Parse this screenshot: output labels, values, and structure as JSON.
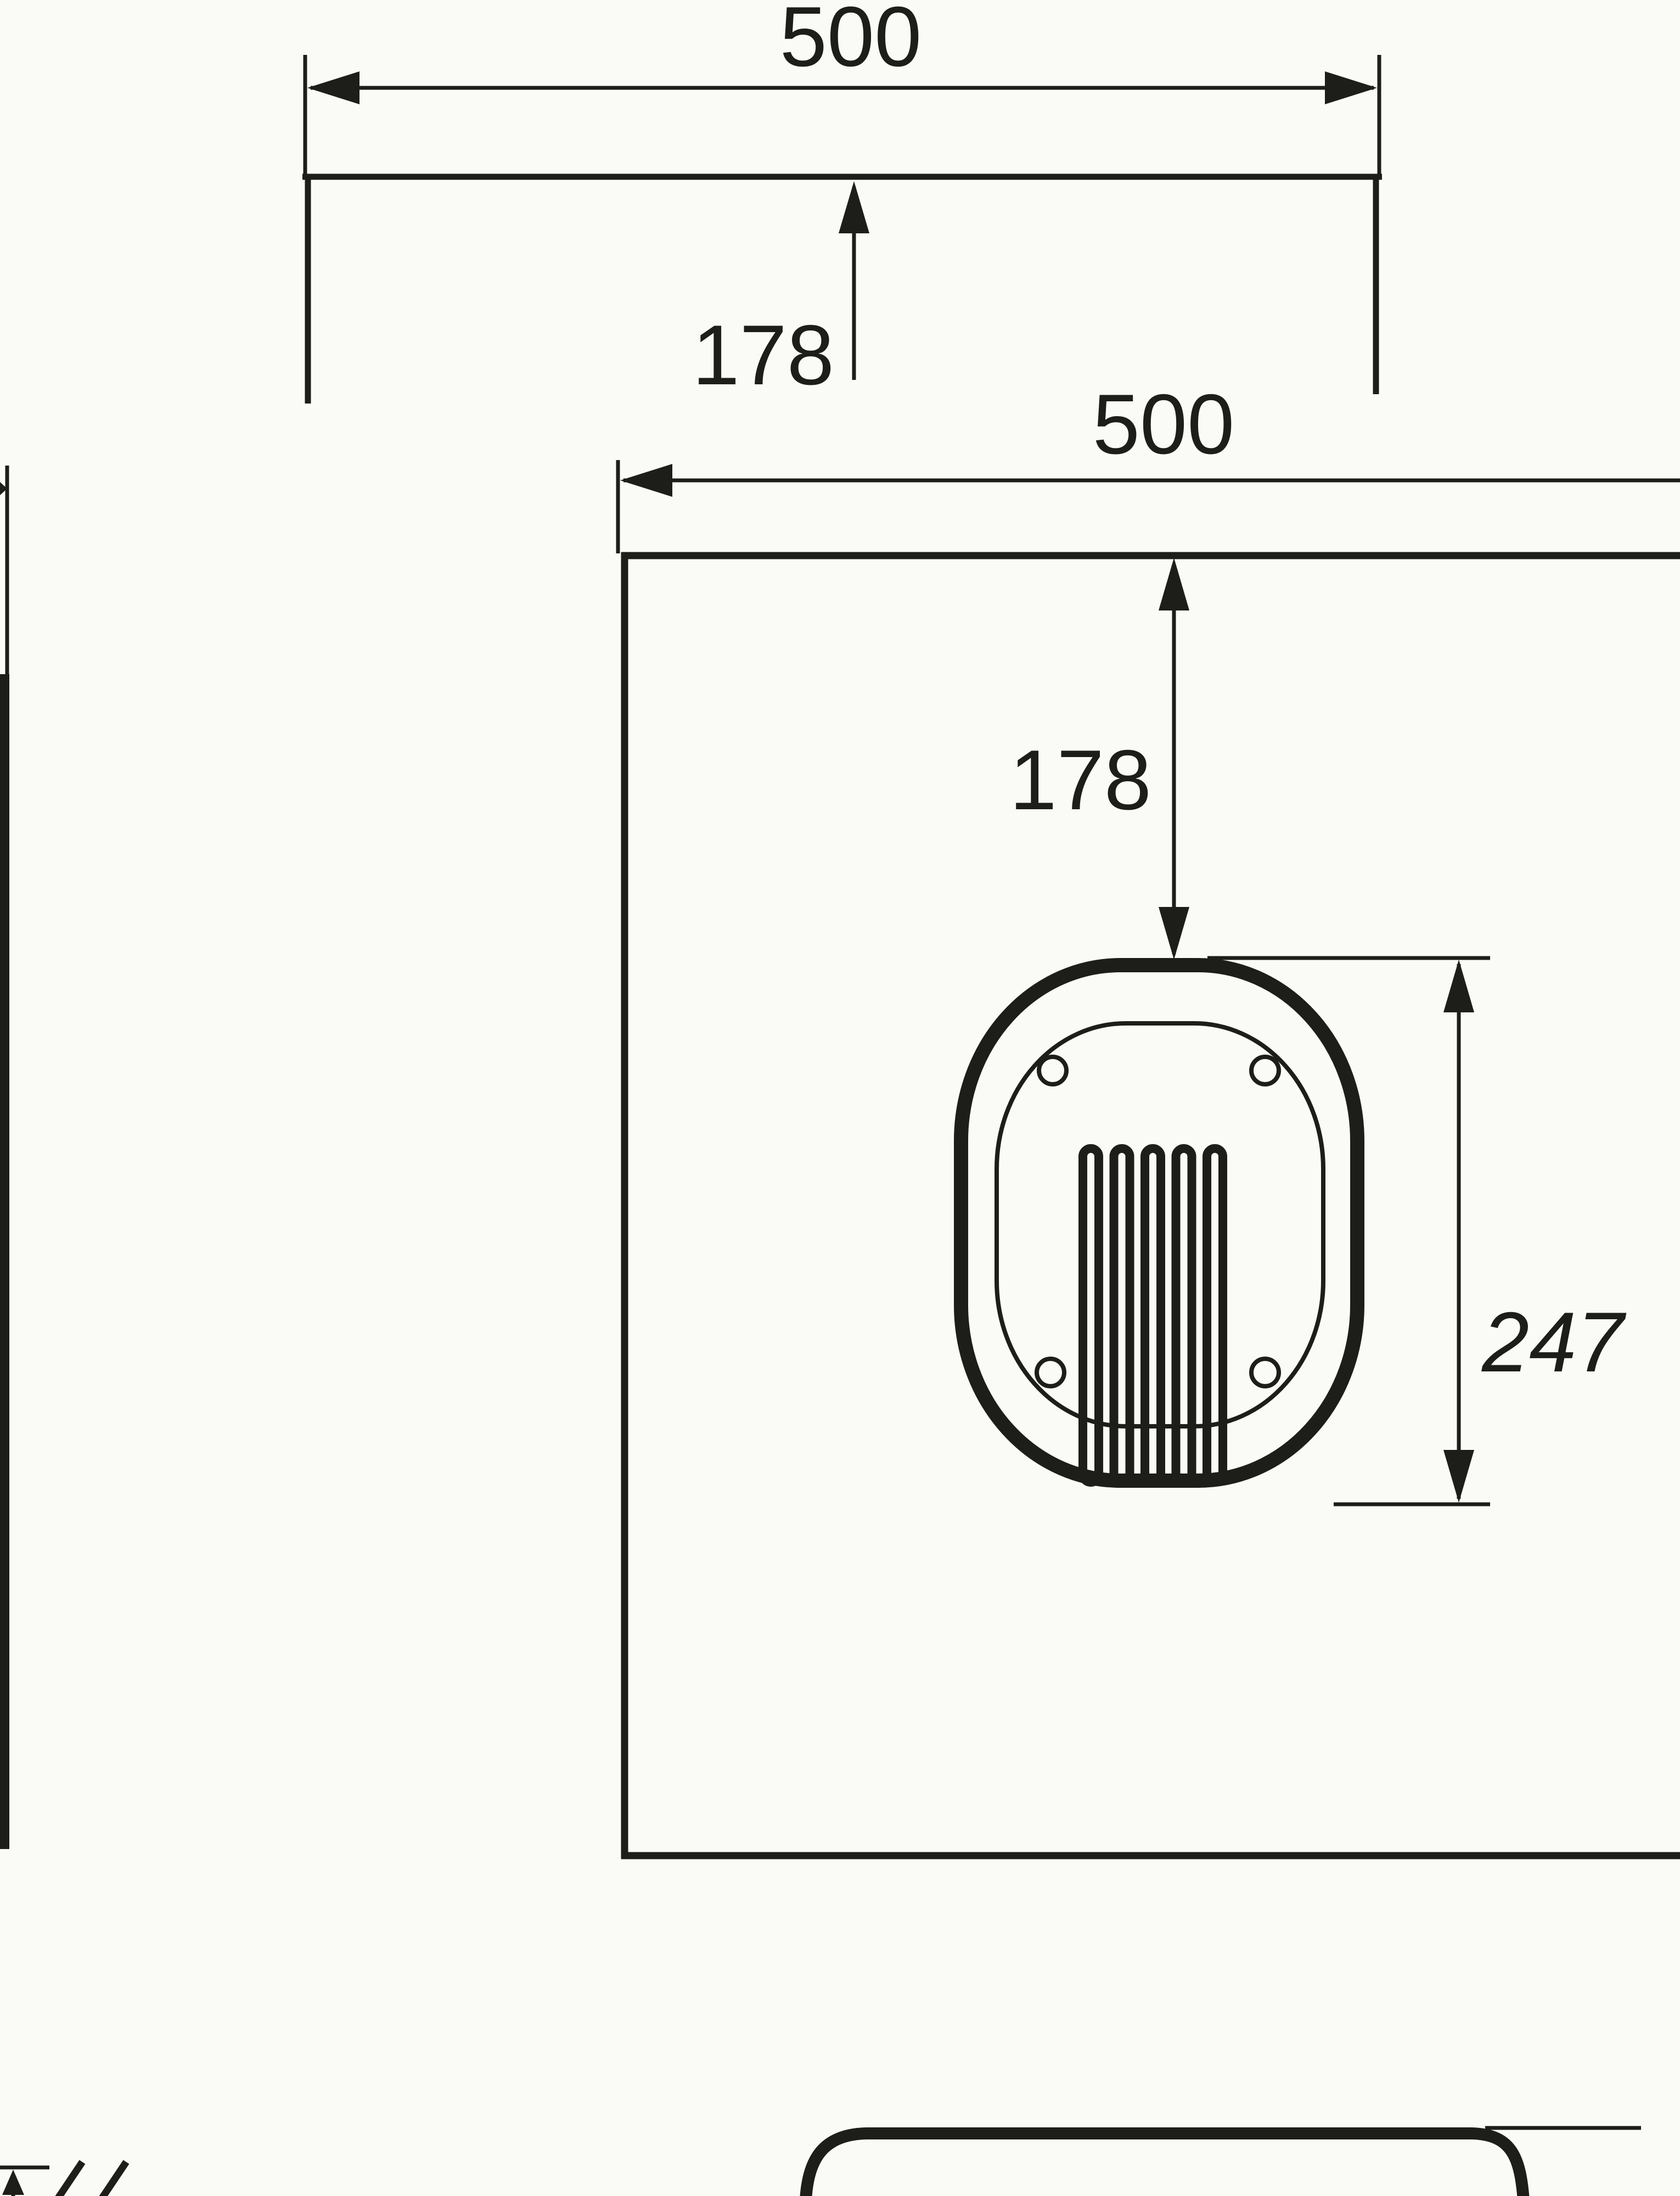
{
  "page": {
    "type": "technical-drawing",
    "paper_color": "#fafaf7",
    "ink_color": "#1d1d19"
  },
  "top_view": {
    "width_label": "500",
    "center_offset_label": "178"
  },
  "front_view": {
    "width_label": "500",
    "center_offset_label": "178",
    "cutout_height_label": "247",
    "bolt_hole_count": 4,
    "element_pass_count": 5
  }
}
